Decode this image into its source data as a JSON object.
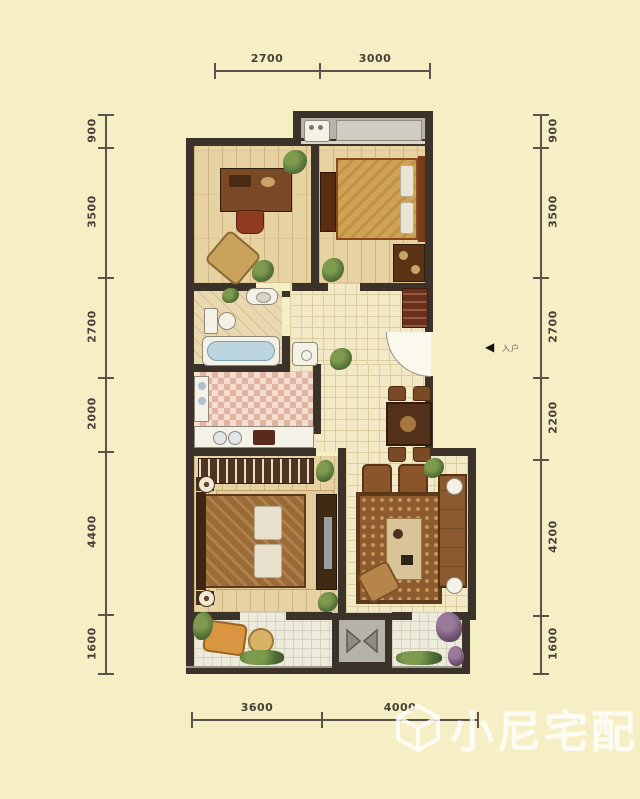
{
  "canvas": {
    "background_color": "#f6efc6",
    "wall_color": "#3b332a",
    "dimension_text_color": "#453f35"
  },
  "dimensions": {
    "top": [
      "2700",
      "3000"
    ],
    "bottom": [
      "3600",
      "4000"
    ],
    "left": [
      "900",
      "3500",
      "2700",
      "2000",
      "4400",
      "1600"
    ],
    "right": [
      "900",
      "3500",
      "2700",
      "2200",
      "4200",
      "1600"
    ]
  },
  "entry": {
    "arrow_glyph": "◀",
    "label": "入户"
  },
  "watermark": {
    "text": "小尼宅配",
    "logo": "cube-logo-icon"
  }
}
